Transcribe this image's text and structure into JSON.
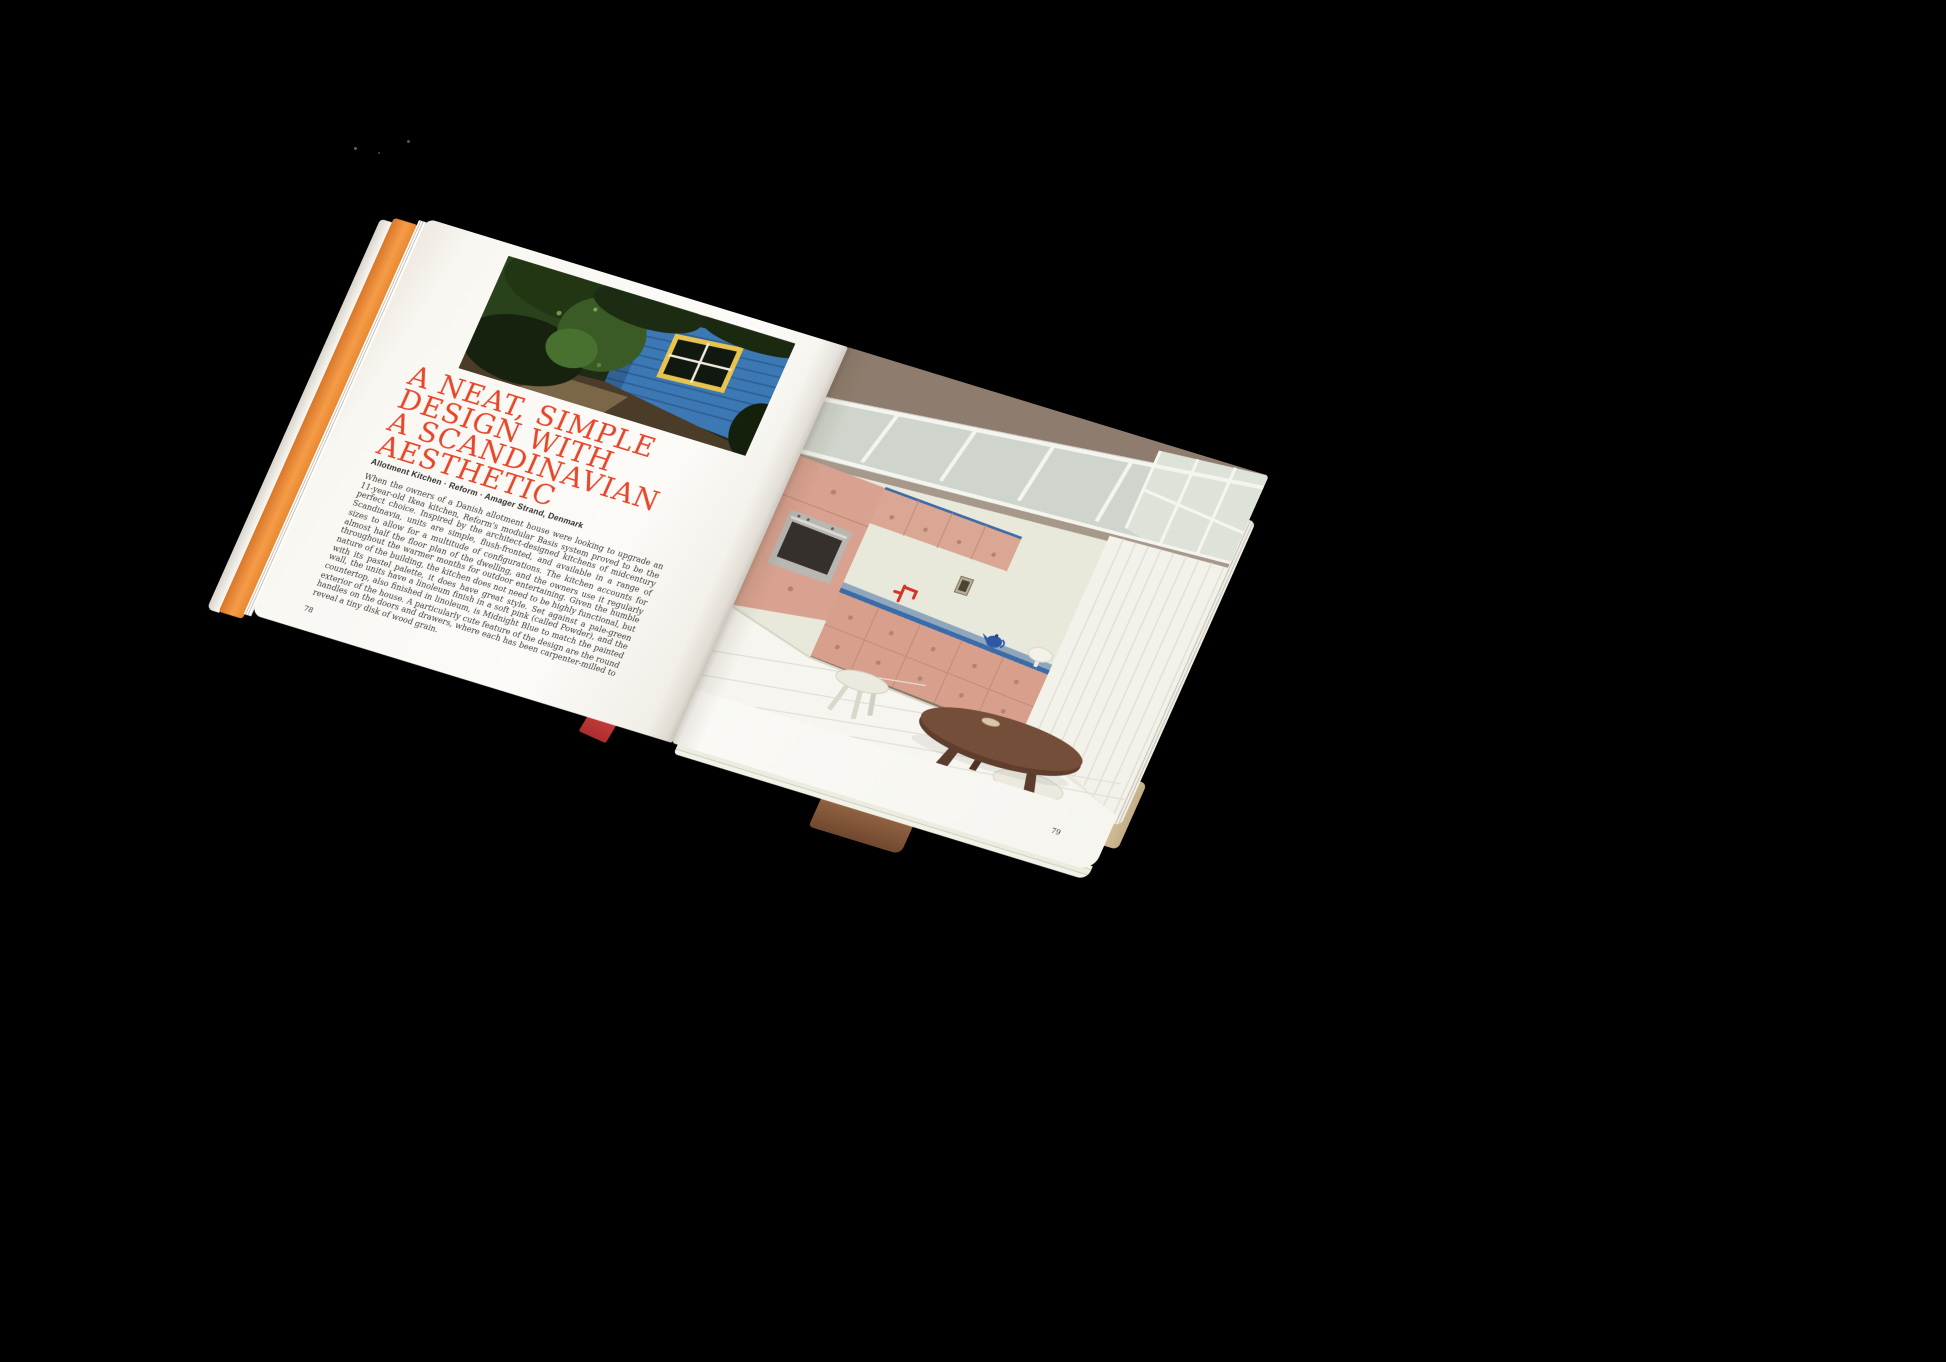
{
  "book": {
    "left_page": {
      "headline_lines": [
        "A NEAT, SIMPLE",
        "DESIGN WITH",
        "A SCANDINAVIAN",
        "AESTHETIC"
      ],
      "credit": "Allotment Kitchen · Reform · Amager Strand, Denmark",
      "body": "When the owners of a Danish allotment house were looking to upgrade an 11-year-old Ikea kitchen, Reform's modular Basis system proved to be the perfect choice. Inspired by the architect-designed kitchens of midcentury Scandinavia, units are simple, flush-fronted, and available in a range of sizes to allow for a multitude of configurations. The kitchen accounts for almost half the floor plan of the dwelling, and the owners use it regularly throughout the warmer months for outdoor entertaining. Given the humble nature of the building, the kitchen does not need to be highly functional, but with its pastel palette, it does have great style. Set against a pale-green wall, the units have a linoleum finish in a soft pink (called Powder), and the countertop, also finished in linoleum, is Midnight Blue to match the painted exterior of the house. A particularly cute feature of the design are the round handles on the doors and drawers, where each has been carpenter-milled to reveal a tiny disk of wood grain.",
      "page_number": "78"
    },
    "right_page": {
      "page_number": "79"
    },
    "colors": {
      "background": "#000000",
      "headline_red": "#e8462a",
      "fore_edge_orange": "#ef8d38",
      "cabinet_pink": "#d9a290",
      "countertop_blue": "#3a6ca8",
      "wall_sage": "#e8e8db",
      "ceiling_taupe": "#8e7d6e",
      "table_wood": "#6e4936",
      "bookmark_red": "#cc3b3b",
      "shed_blue": "#3c78b4",
      "window_yellow": "#e7c44d"
    }
  }
}
